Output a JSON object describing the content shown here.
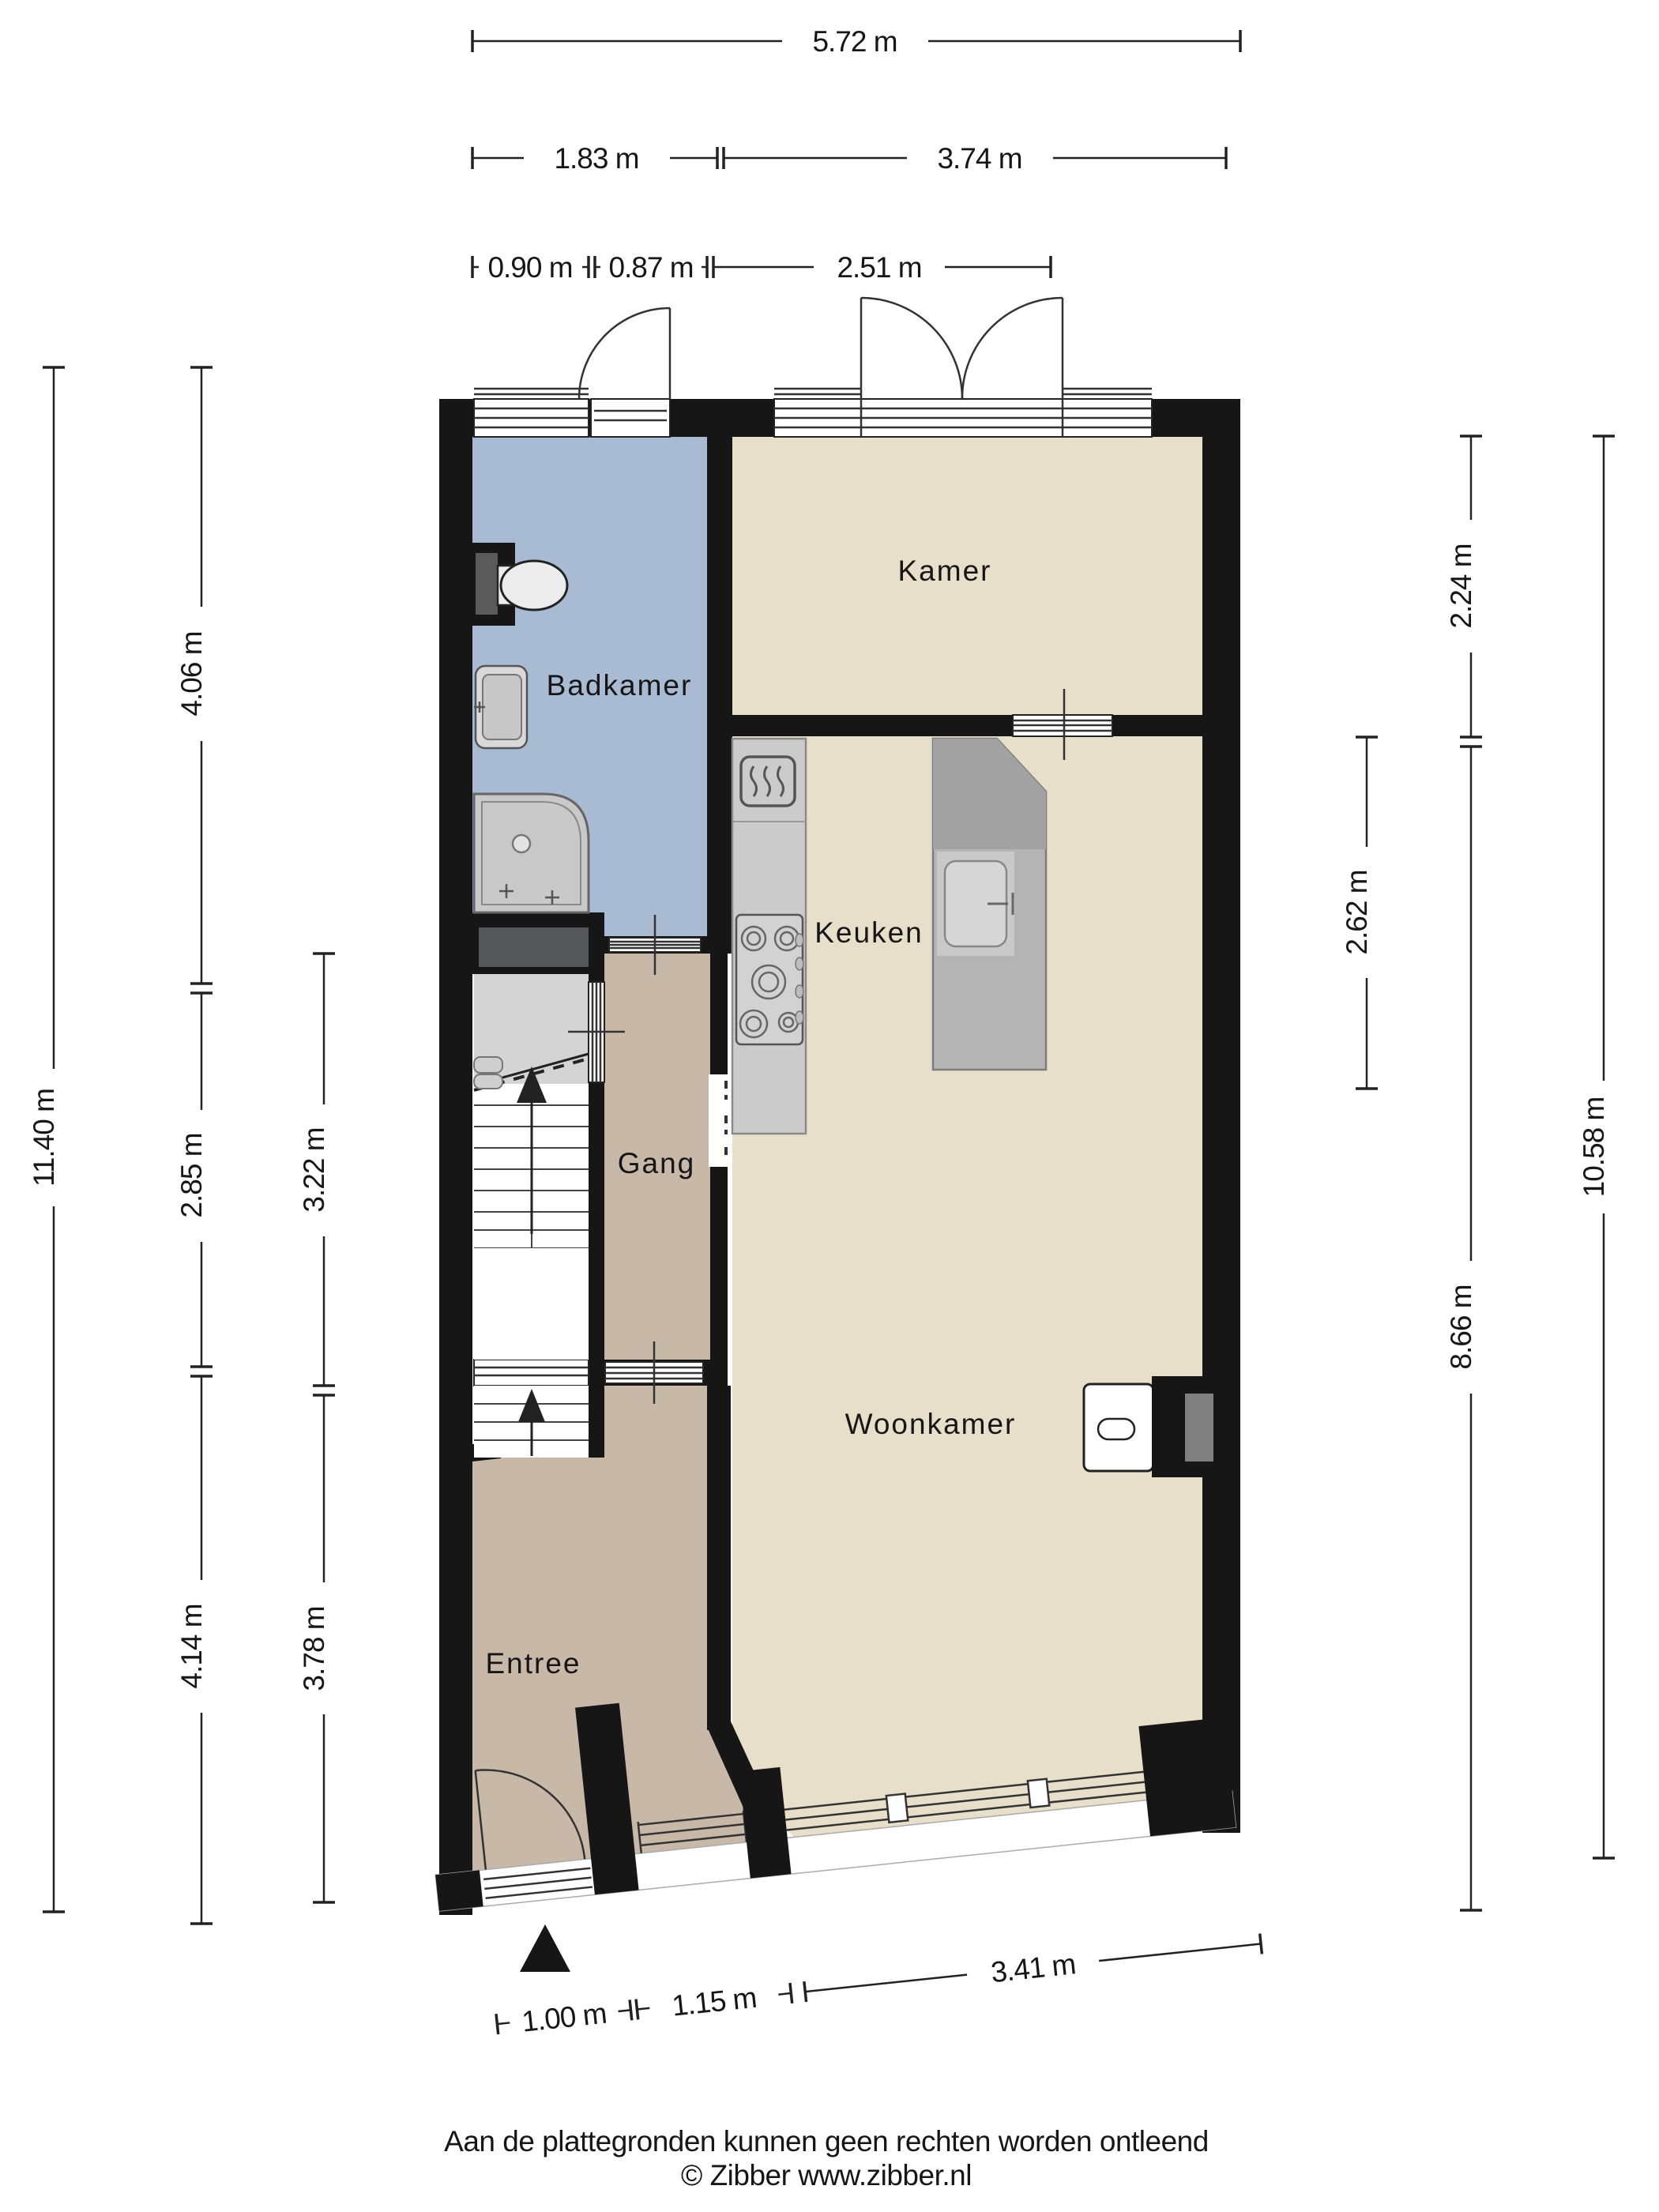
{
  "rooms": {
    "badkamer": "Badkamer",
    "kamer": "Kamer",
    "keuken": "Keuken",
    "gang": "Gang",
    "woonkamer": "Woonkamer",
    "entree": "Entree"
  },
  "dimensions": {
    "top": [
      "5.72 m",
      "1.83 m",
      "3.74 m",
      "0.90 m",
      "0.87 m",
      "2.51 m"
    ],
    "left": [
      "11.40 m",
      "4.06 m",
      "2.85 m",
      "4.14 m",
      "3.22 m",
      "3.78 m"
    ],
    "right": [
      "2.24 m",
      "2.62 m",
      "8.66 m",
      "10.58 m"
    ],
    "bottom": [
      "1.00 m",
      "1.15 m",
      "3.41 m"
    ]
  },
  "footer": {
    "disclaimer": "Aan de plattegronden kunnen geen rechten worden ontleend",
    "copyright": "© Zibber www.zibber.nl"
  },
  "colors": {
    "wall": "#161616",
    "floor_beige": "#e7dfc9",
    "floor_blue": "#a8bbd3",
    "floor_tan": "#c8b8a8",
    "counter_gray": "#cbcbcb",
    "island_gray": "#b4b4b4",
    "stairs_gray": "#dedede",
    "niche_gray": "#55565a",
    "dimension_ink": "#222222"
  },
  "icons": {
    "north_arrow": "solid triangle pointing up",
    "heater": "rounded square with three wavy lines",
    "stove": "five-burner gas hob"
  }
}
